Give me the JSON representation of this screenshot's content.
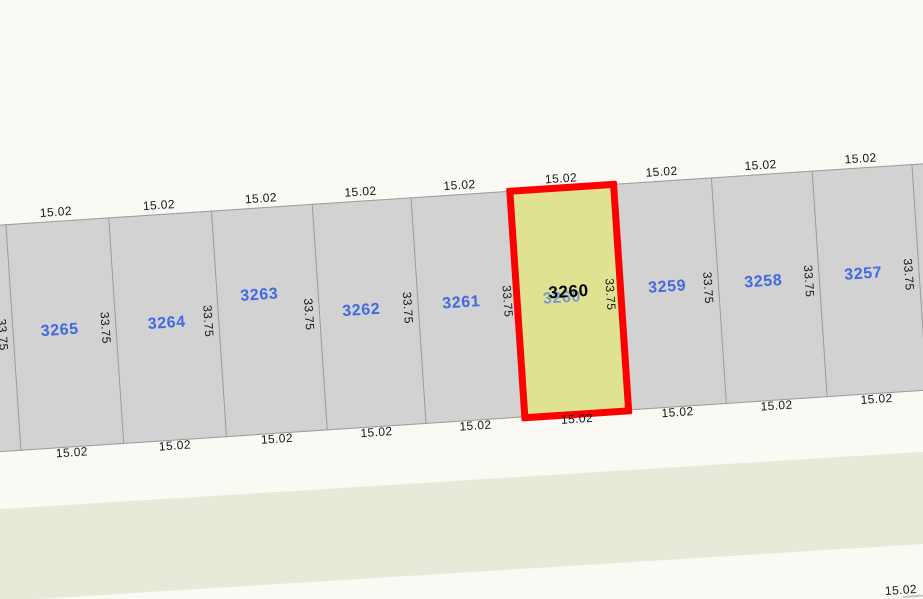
{
  "map": {
    "colors": {
      "background": "#faf9f4",
      "parcel_fill": "#d2d2d2",
      "boundary_line": "#9b9b9b",
      "parcel_number": "#4169e1",
      "dimension_text": "#161616",
      "selected_fill": "#dfe391",
      "selected_outline": "#ff0000",
      "selected_number": "#000000",
      "covered_number": "#7d99d4",
      "green_band": "#e7ead8",
      "adjacent_edge_line": "#c4c4c4"
    },
    "selected_parcel": "3260",
    "parcels": [
      {
        "number": "3265",
        "front": "15.02",
        "rear": "15.02",
        "x": 31.6,
        "width": 103.2,
        "ldx": -4,
        "ldy": 110,
        "selected": false
      },
      {
        "number": "3264",
        "front": "15.02",
        "rear": "15.02",
        "x": 134.8,
        "width": 103.3,
        "ldx": 0,
        "ldy": 110,
        "selected": false
      },
      {
        "number": "3263",
        "front": "15.02",
        "rear": "15.02",
        "x": 238.1,
        "width": 101.2,
        "ldx": -8,
        "ldy": 88,
        "selected": false
      },
      {
        "number": "3262",
        "front": "15.02",
        "rear": "15.02",
        "x": 339.3,
        "width": 98.3,
        "ldx": -7,
        "ldy": 110,
        "selected": false
      },
      {
        "number": "3261",
        "front": "15.02",
        "rear": "15.02",
        "x": 437.6,
        "width": 100.2,
        "ldx": -6,
        "ldy": 109,
        "selected": false
      },
      {
        "number": "3260",
        "front": "15.02",
        "rear": "15.02",
        "x": 537.8,
        "width": 103.3,
        "ldx": -7,
        "ldy": 111,
        "selected": true
      },
      {
        "number": "3259",
        "front": "15.02",
        "rear": "15.02",
        "x": 641.1,
        "width": 98.2,
        "ldx": -2,
        "ldy": 107,
        "selected": false
      },
      {
        "number": "3258",
        "front": "15.02",
        "rear": "15.02",
        "x": 739.3,
        "width": 100.3,
        "ldx": -5,
        "ldy": 108,
        "selected": false
      },
      {
        "number": "3257",
        "front": "15.02",
        "rear": "15.02",
        "x": 839.6,
        "width": 100.2,
        "ldx": -5,
        "ldy": 107,
        "selected": false
      }
    ],
    "boundaries": [
      {
        "x": 31.6,
        "depth": "33.75"
      },
      {
        "x": 134.8,
        "depth": "33.75"
      },
      {
        "x": 238.1,
        "depth": "33.75"
      },
      {
        "x": 339.3,
        "depth": "33.75"
      },
      {
        "x": 437.6,
        "depth": "33.75"
      },
      {
        "x": 537.8,
        "depth": "33.75"
      },
      {
        "x": 641.1,
        "depth": "33.75"
      },
      {
        "x": 739.3,
        "depth": "33.75"
      },
      {
        "x": 839.6,
        "depth": "33.75"
      },
      {
        "x": 939.8,
        "depth": "33.75"
      }
    ],
    "adjacent_row_label": "15.02"
  }
}
